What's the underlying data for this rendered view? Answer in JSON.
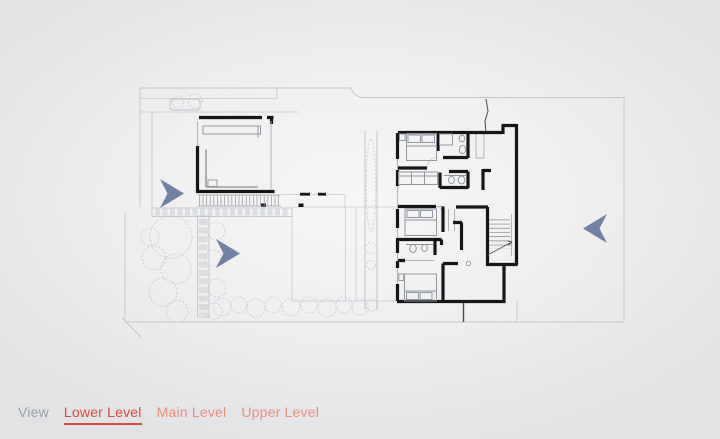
{
  "window": {
    "width": 720,
    "height": 439
  },
  "canvas": {
    "background_center": "#f6f6f7",
    "background_edge": "#e3e3e5"
  },
  "plan": {
    "title": "Residence site plan — lower level",
    "wall_color": "#161616",
    "furniture_color": "#8d949c",
    "site_line_color": "#c3c6cb",
    "landscape_color": "#cdd2d8"
  },
  "viewer": {
    "arrow_color": "#6a7aa1",
    "arrows": [
      {
        "icon": "nav-arrow-right-icon",
        "direction": "right",
        "transform": "translate(160,179)"
      },
      {
        "icon": "nav-arrow-right-icon",
        "direction": "right",
        "transform": "translate(216,239)"
      },
      {
        "icon": "nav-arrow-left-icon",
        "direction": "left",
        "transform": "translate(583,214)"
      }
    ]
  },
  "toolbar": {
    "view_label": "View",
    "view_label_color": "#97a0ab",
    "active_color": "#dd4a3e",
    "inactive_color": "#ea8d81",
    "tabs": [
      {
        "id": "lower",
        "label": "Lower Level",
        "active": true
      },
      {
        "id": "main",
        "label": "Main Level",
        "active": false
      },
      {
        "id": "upper",
        "label": "Upper Level",
        "active": false
      }
    ]
  }
}
